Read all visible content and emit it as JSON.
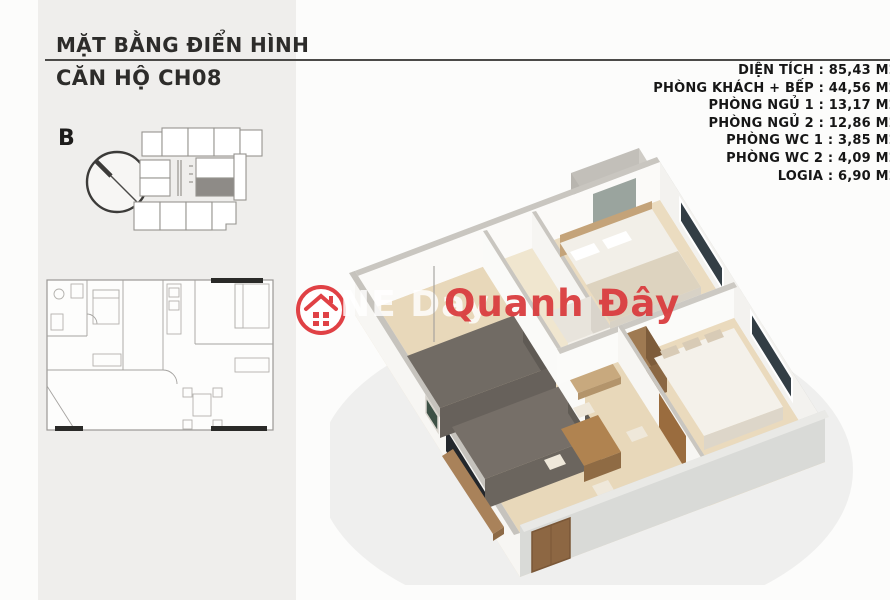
{
  "title": {
    "line1": "MẶT BẰNG ĐIỂN HÌNH",
    "line2": "CĂN HỘ CH08"
  },
  "specs": {
    "items": [
      {
        "text": "DIỆN TÍCH : 85,43 M2"
      },
      {
        "text": "PHÒNG KHÁCH + BẾP : 44,56 M2"
      },
      {
        "text": "PHÒNG NGỦ 1 : 13,17 M2"
      },
      {
        "text": "PHÒNG NGỦ 2 : 12,86 M2"
      },
      {
        "text": "PHÒNG WC 1 : 3,85 M2"
      },
      {
        "text": "PHÒNG WC 2 : 4,09 M2"
      },
      {
        "text": "LOGIA : 6,90 M2"
      }
    ]
  },
  "compass": {
    "label": "B",
    "icon": "compass-circle-icon"
  },
  "key_plan": {
    "icon": "building-key-plan",
    "highlighted_unit_fill": "#8e8b87"
  },
  "floor_plan_2d": {
    "icon": "2d-floor-plan-drawing"
  },
  "render_3d": {
    "icon": "3d-apartment-render"
  },
  "watermark": {
    "logo_icon": "house-in-circle-icon",
    "text_white": "NE Day",
    "text_red": "Quanh Đây",
    "red": "#d93c3e"
  },
  "colors": {
    "panel_gray": "#efeeec",
    "rule": "#4b4a48",
    "text_dark": "#161616",
    "wood_floor": "#e8d8ba",
    "wall_top": "#c9c6c0",
    "outer_wall_gray": "#d6d6d3",
    "marble_dark": "#6e6862"
  }
}
